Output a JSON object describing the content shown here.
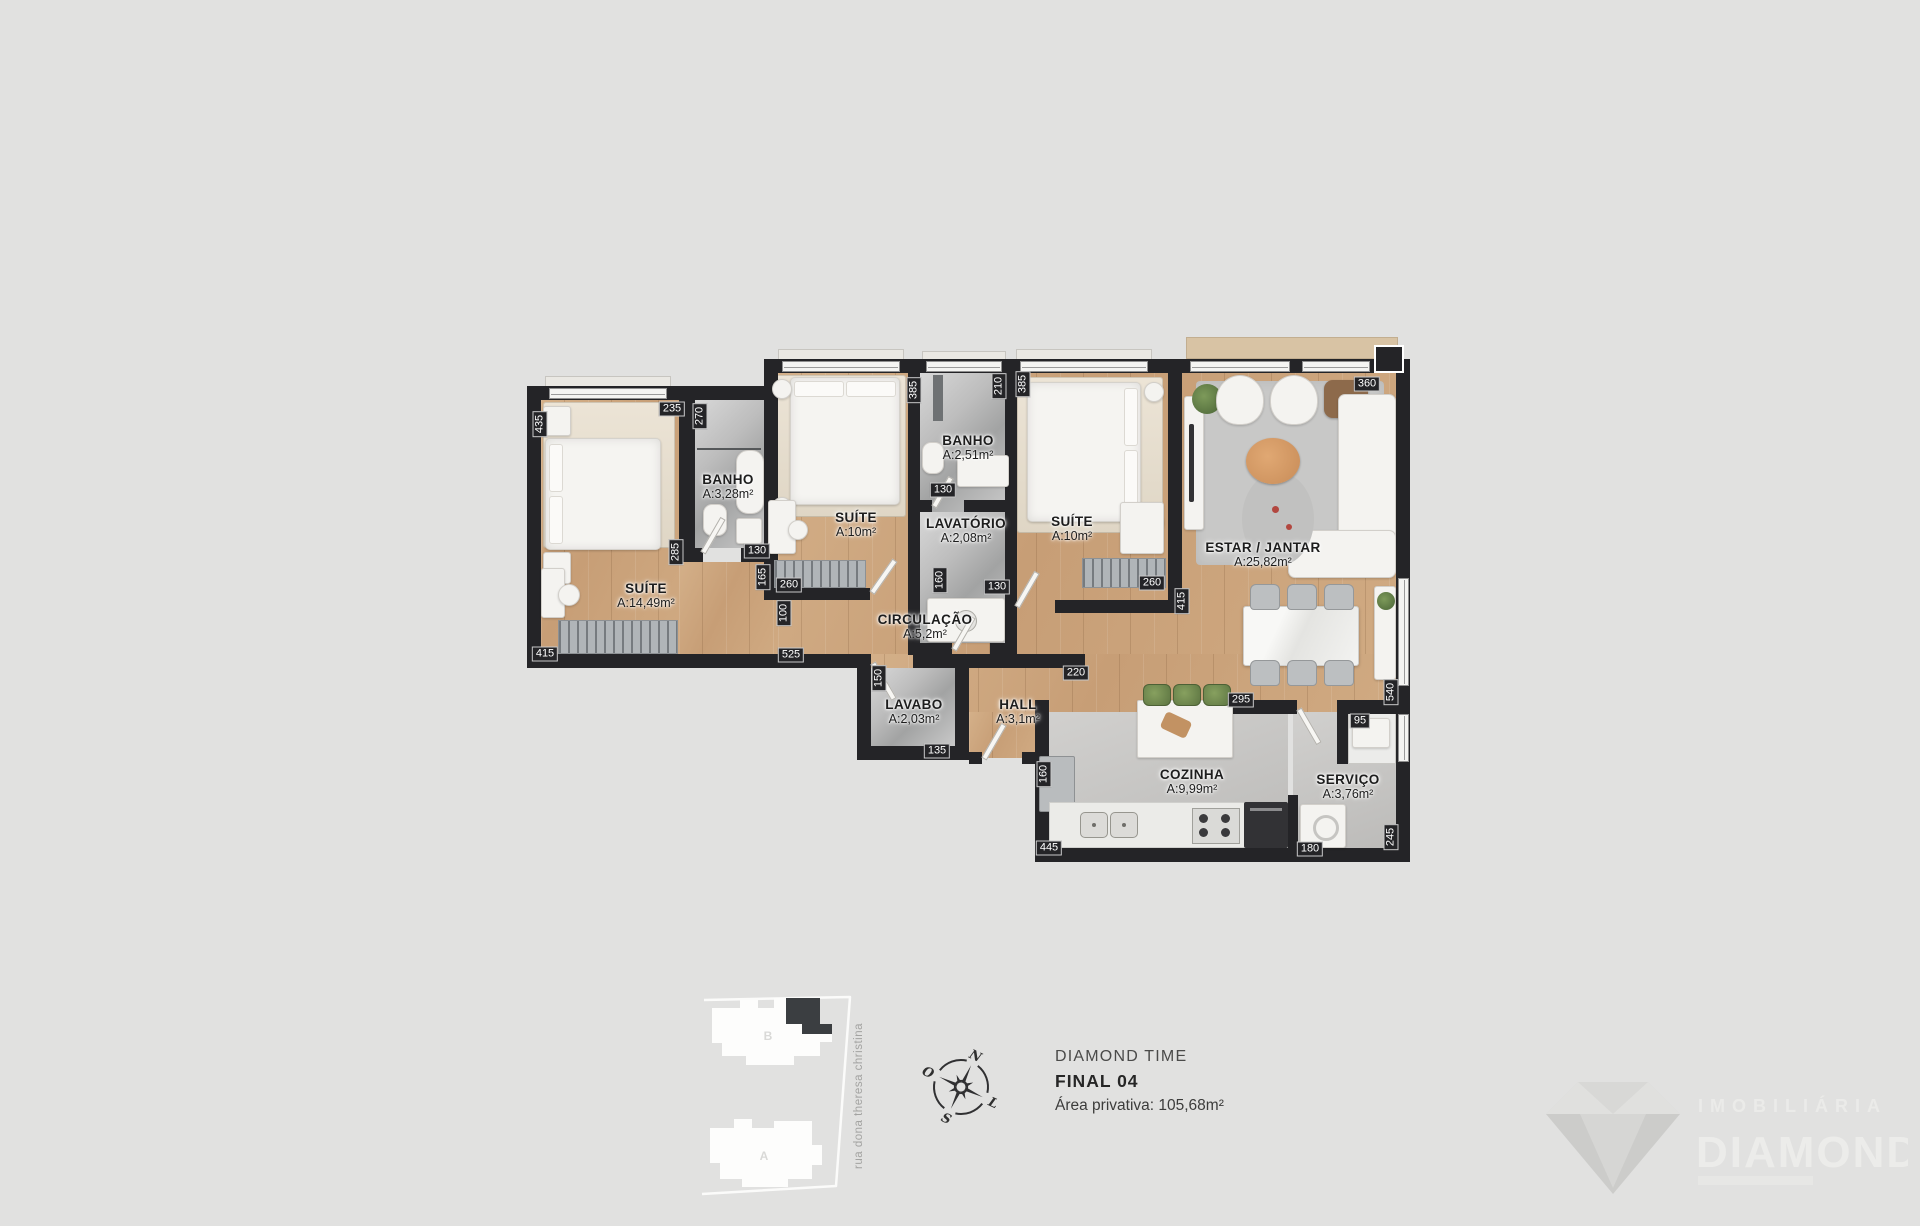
{
  "colors": {
    "background": "#e1e1e0",
    "wall": "#242427",
    "wood_floor": "#cda57e",
    "tile_floor": "#bfbfbf",
    "highlight_unit": "#3b3e41"
  },
  "floor_plan": {
    "rooms": [
      {
        "id": "suite-1",
        "label": "SUÍTE",
        "area": "A:14,49m²",
        "x": 646,
        "y": 596
      },
      {
        "id": "banho-1",
        "label": "BANHO",
        "area": "A:3,28m²",
        "x": 728,
        "y": 487
      },
      {
        "id": "suite-2",
        "label": "SUÍTE",
        "area": "A:10m²",
        "x": 856,
        "y": 525
      },
      {
        "id": "banho-2",
        "label": "BANHO",
        "area": "A:2,51m²",
        "x": 968,
        "y": 448
      },
      {
        "id": "lavatorio",
        "label": "LAVATÓRIO",
        "area": "A:2,08m²",
        "x": 966,
        "y": 531
      },
      {
        "id": "suite-3",
        "label": "SUÍTE",
        "area": "A:10m²",
        "x": 1072,
        "y": 529
      },
      {
        "id": "estar-jantar",
        "label": "ESTAR / JANTAR",
        "area": "A:25,82m²",
        "x": 1263,
        "y": 555
      },
      {
        "id": "circulacao",
        "label": "CIRCULAÇÃO",
        "area": "A:5,2m²",
        "x": 925,
        "y": 627
      },
      {
        "id": "lavabo",
        "label": "LAVABO",
        "area": "A:2,03m²",
        "x": 914,
        "y": 712
      },
      {
        "id": "hall",
        "label": "HALL",
        "area": "A:3,1m²",
        "x": 1018,
        "y": 712
      },
      {
        "id": "cozinha",
        "label": "COZINHA",
        "area": "A:9,99m²",
        "x": 1192,
        "y": 782
      },
      {
        "id": "servico",
        "label": "SERVIÇO",
        "area": "A:3,76m²",
        "x": 1348,
        "y": 787
      }
    ],
    "dimensions": [
      {
        "v": "435",
        "x": 540,
        "y": 424,
        "rot": true
      },
      {
        "v": "235",
        "x": 672,
        "y": 409,
        "rot": false
      },
      {
        "v": "270",
        "x": 700,
        "y": 416,
        "rot": true
      },
      {
        "v": "385",
        "x": 914,
        "y": 390,
        "rot": true
      },
      {
        "v": "210",
        "x": 999,
        "y": 386,
        "rot": true
      },
      {
        "v": "385",
        "x": 1023,
        "y": 384,
        "rot": true
      },
      {
        "v": "360",
        "x": 1367,
        "y": 384,
        "rot": false
      },
      {
        "v": "285",
        "x": 676,
        "y": 552,
        "rot": true
      },
      {
        "v": "130",
        "x": 757,
        "y": 551,
        "rot": false
      },
      {
        "v": "165",
        "x": 763,
        "y": 577,
        "rot": true
      },
      {
        "v": "260",
        "x": 789,
        "y": 585,
        "rot": false
      },
      {
        "v": "100",
        "x": 784,
        "y": 613,
        "rot": true
      },
      {
        "v": "130",
        "x": 943,
        "y": 490,
        "rot": false
      },
      {
        "v": "160",
        "x": 940,
        "y": 580,
        "rot": true
      },
      {
        "v": "130",
        "x": 997,
        "y": 587,
        "rot": false
      },
      {
        "v": "260",
        "x": 1152,
        "y": 583,
        "rot": false
      },
      {
        "v": "415",
        "x": 1182,
        "y": 601,
        "rot": true
      },
      {
        "v": "415",
        "x": 545,
        "y": 654,
        "rot": false
      },
      {
        "v": "525",
        "x": 791,
        "y": 655,
        "rot": false
      },
      {
        "v": "150",
        "x": 879,
        "y": 678,
        "rot": true
      },
      {
        "v": "135",
        "x": 937,
        "y": 751,
        "rot": false
      },
      {
        "v": "220",
        "x": 1076,
        "y": 673,
        "rot": false
      },
      {
        "v": "295",
        "x": 1241,
        "y": 700,
        "rot": false
      },
      {
        "v": "540",
        "x": 1391,
        "y": 692,
        "rot": true
      },
      {
        "v": "95",
        "x": 1360,
        "y": 721,
        "rot": false
      },
      {
        "v": "160",
        "x": 1044,
        "y": 774,
        "rot": true
      },
      {
        "v": "445",
        "x": 1049,
        "y": 848,
        "rot": false
      },
      {
        "v": "180",
        "x": 1310,
        "y": 849,
        "rot": false
      },
      {
        "v": "245",
        "x": 1391,
        "y": 837,
        "rot": true
      }
    ]
  },
  "site_plan": {
    "street_name": "rua dona theresa christina",
    "building_top_label": "B",
    "building_bottom_label": "A"
  },
  "compass": {
    "north": "N",
    "south": "S",
    "west": "O",
    "east": "L"
  },
  "title_block": {
    "project_name": "DIAMOND TIME",
    "unit_label": "FINAL 04",
    "private_area": "Área privativa: 105,68m²"
  },
  "logo": {
    "line1": "IMOBILIÁRIA",
    "line2": "DIAMOND"
  }
}
